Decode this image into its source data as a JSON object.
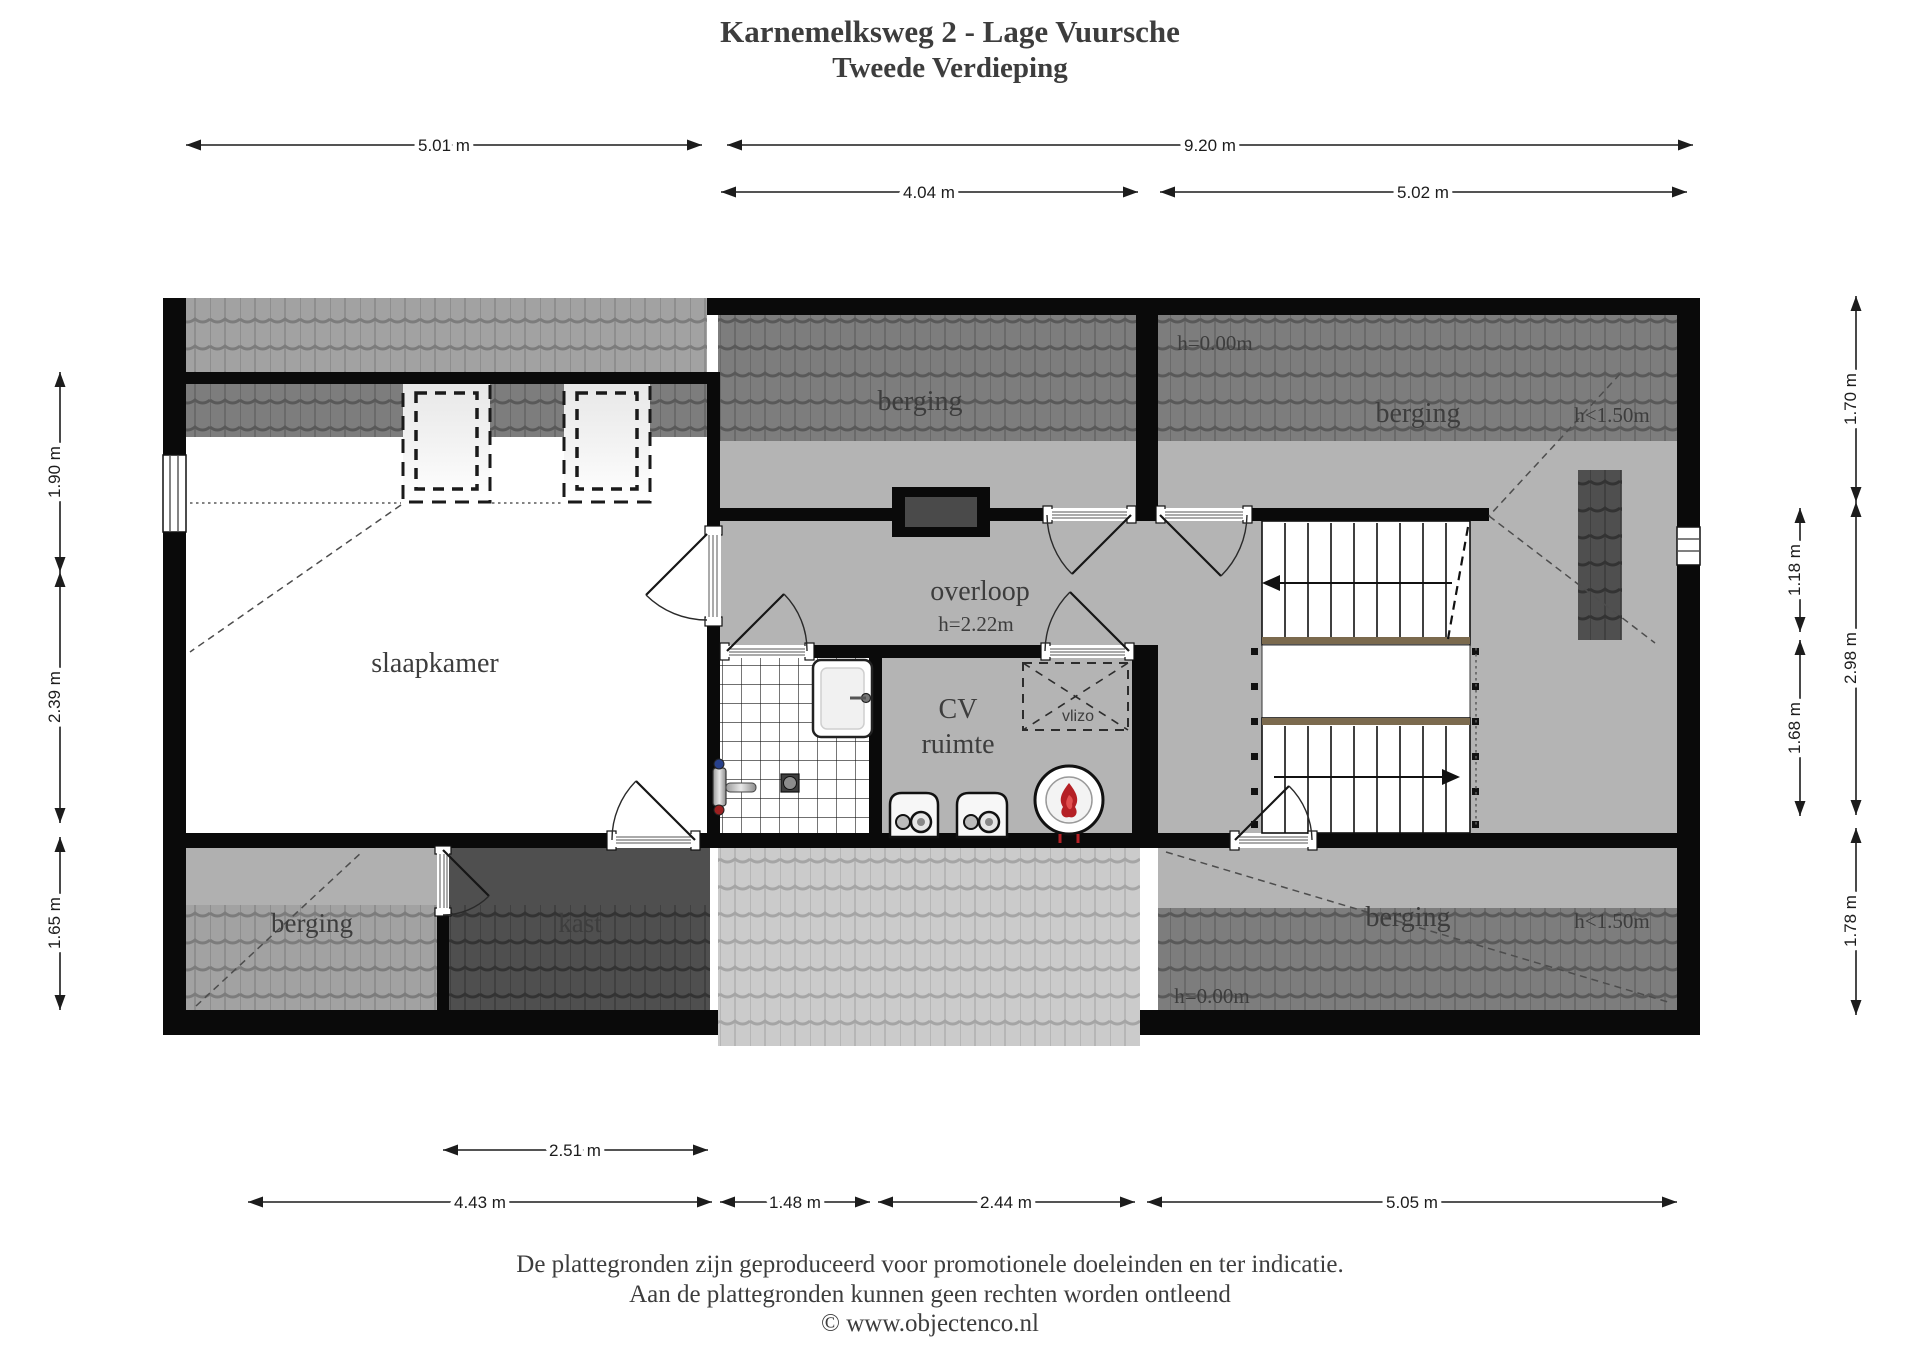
{
  "title": {
    "line1": "Karnemelksweg 2 - Lage Vuursche",
    "line2": "Tweede Verdieping"
  },
  "rooms": {
    "slaapkamer": "slaapkamer",
    "berging_top_middle": "berging",
    "berging_top_right": "berging",
    "berging_bottom_left": "berging",
    "berging_bottom_right": "berging",
    "kast": "kast",
    "overloop": "overloop",
    "overloop_height": "h=2.22m",
    "cv_line1": "CV",
    "cv_line2": "ruimte",
    "vlizo": "vlizo"
  },
  "annotations": {
    "h_zero_top": "h=0.00m",
    "h_zero_bottom": "h=0.00m",
    "h_150_top": "h<1.50m",
    "h_150_bottom": "h<1.50m"
  },
  "dimensions": {
    "top": [
      {
        "label": "5.01 m"
      },
      {
        "label": "9.20 m"
      }
    ],
    "top2": [
      {
        "label": "4.04 m"
      },
      {
        "label": "5.02 m"
      }
    ],
    "left": [
      {
        "label": "1.90 m"
      },
      {
        "label": "2.39 m"
      },
      {
        "label": "1.65 m"
      }
    ],
    "right_inner": [
      {
        "label": "1.18 m"
      },
      {
        "label": "1.68 m"
      }
    ],
    "right_outer": [
      {
        "label": "1.70 m"
      },
      {
        "label": "2.98 m"
      },
      {
        "label": "1.78 m"
      }
    ],
    "bottom_kast": [
      {
        "label": "2.51 m"
      }
    ],
    "bottom": [
      {
        "label": "4.43 m"
      },
      {
        "label": "1.48 m"
      },
      {
        "label": "2.44 m"
      },
      {
        "label": "5.05 m"
      }
    ]
  },
  "footer": {
    "line1": "De plattegronden zijn geproduceerd voor promotionele doeleinden en ter indicatie.",
    "line2": "Aan de plattegronden kunnen geen rechten worden ontleend",
    "line3": "© www.objectenco.nl"
  },
  "colors": {
    "wall": "#0a0a0a",
    "floor": "#b4b4b4",
    "stair_wood": "#7b6a4e",
    "flame_red": "#b52025"
  }
}
